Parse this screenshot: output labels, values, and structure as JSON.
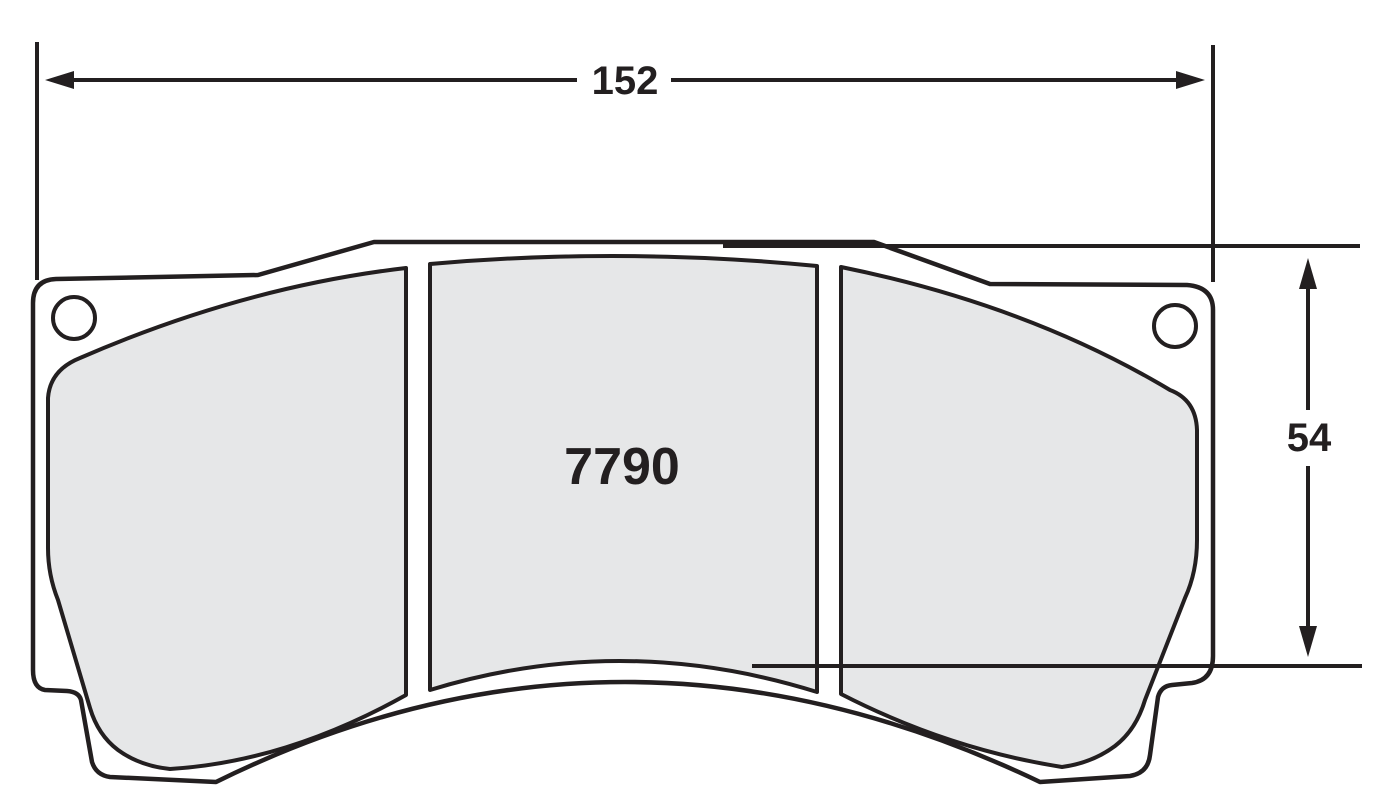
{
  "part_number": "7790",
  "dimensions": {
    "width": {
      "value": "152"
    },
    "height": {
      "value": "54"
    }
  },
  "colors": {
    "line": "#231f20",
    "pad_fill": "#e6e7e8",
    "background": "#ffffff"
  }
}
